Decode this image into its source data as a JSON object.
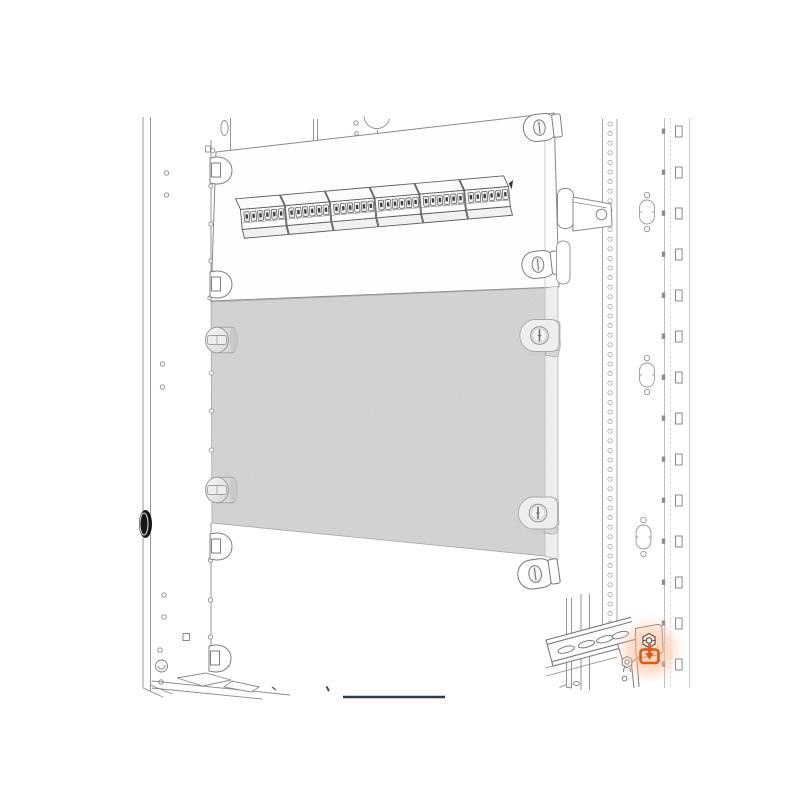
{
  "illustration": {
    "subject": "enclosure-blind-panel-mounting",
    "highlight_symbol": "screw-fixing-point"
  },
  "colors": {
    "background": "#ffffff",
    "line": "#6e6e6e",
    "line_light": "#a6a6a6",
    "panel_face": "#d8d9d8",
    "panel_side": "#ecedec",
    "hole_black": "#161616",
    "highlight_orange": "#e8540e",
    "highlight_glow": "#f6bb92",
    "dark_line": "#313c52",
    "terminal_dark": "#3a3a3a"
  },
  "parts": {
    "frame": "enclosure-frame",
    "terminal_strip": "din-terminal-strip",
    "blind_panel": "blind-panel",
    "fasteners": "quarter-turn-fasteners",
    "din_rail": "din-rail",
    "fixing_screw": "highlighted-fixing-screw"
  }
}
